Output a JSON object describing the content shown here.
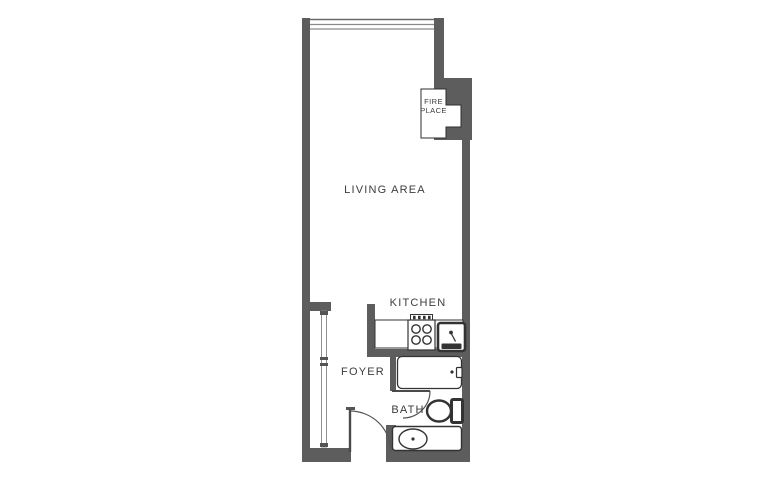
{
  "floor_plan": {
    "rooms": {
      "living_area": "LIVING AREA",
      "kitchen": "KITCHEN",
      "foyer": "FOYER",
      "bath": "BATH"
    },
    "fireplace": {
      "line1": "FIRE",
      "line2": "PLACE"
    },
    "colors": {
      "wall": "#5d5d5d",
      "fixture_outline": "#333333",
      "door_line": "#555555",
      "window_line": "#8a8a8a",
      "label_text": "#3c3c3c",
      "background": "#ffffff"
    }
  }
}
